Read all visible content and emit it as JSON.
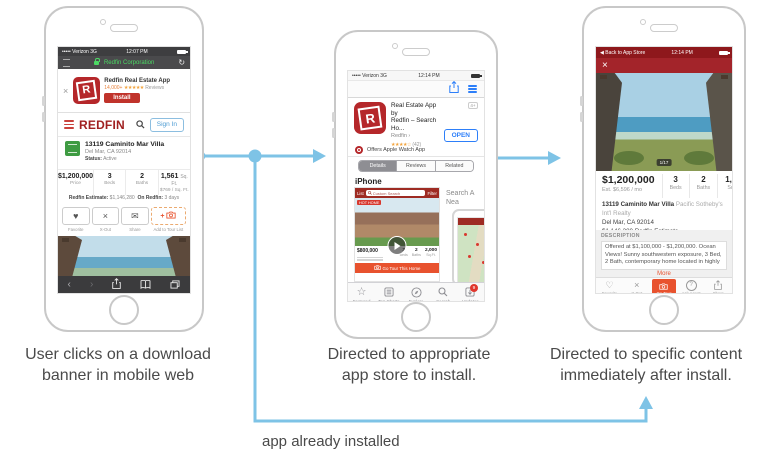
{
  "colors": {
    "arrow": "#7EC3E6",
    "redfin-red": "#A02021",
    "install-red": "#C0332B",
    "accent-orange": "#E8522E",
    "ios-blue": "#2D7FF9",
    "star-orange": "#F2A33C",
    "status-green": "#4CD964"
  },
  "captions": {
    "step1": "User clicks on a download\nbanner in mobile web",
    "step2": "Directed to appropriate\napp store to install.",
    "step3": "Directed to specific content\nimmediately after install.",
    "loop": "app already installed"
  },
  "phone1": {
    "status": {
      "carrier": "••••• Verizon 3G",
      "time": "12:07 PM"
    },
    "addressbar": {
      "title": "Redfin Corporation",
      "refresh": "↻"
    },
    "banner": {
      "close": "×",
      "logo_letter": "R",
      "app_name": "Redfin Real Estate App",
      "rating_count": "14,000+",
      "stars": "★★★★★",
      "reviews_label": "Reviews",
      "install_label": "Install"
    },
    "header": {
      "logo": "REDFIN",
      "sign_in": "Sign In"
    },
    "listing": {
      "address": "13119 Caminito Mar Villa",
      "city": "Del Mar, CA 92014",
      "status_label": "Status:",
      "status_value": "Active"
    },
    "stats": [
      {
        "value": "$1,200,000",
        "label": "Price"
      },
      {
        "value": "3",
        "label": "Beds"
      },
      {
        "value": "2",
        "label": "Baths"
      },
      {
        "value": "1,561",
        "unit": "Sq. Ft.",
        "label": "$769 / Sq. Ft."
      }
    ],
    "estimate": {
      "label": "Redfin Estimate:",
      "value": "$1,146,280",
      "on_label": "On Redfin:",
      "on_value": "3 days"
    },
    "actions": {
      "heart": "♥",
      "x": "×",
      "envelope": "✉",
      "plus": "+",
      "favorite": "Favorite",
      "xout": "X-Out",
      "share": "Share",
      "tour": "Add to Tour List"
    },
    "nav": {
      "back": "‹",
      "forward": "›"
    }
  },
  "phone2": {
    "status": {
      "carrier": "••••• Verizon 3G",
      "time": "12:14 PM"
    },
    "app": {
      "logo_letter": "R",
      "title": "Real Estate App by\nRedfin – Search Ho...",
      "developer": "Redfin ›",
      "age": "4+",
      "stars": "★★★★☆",
      "ratings": "(42)",
      "open_label": "OPEN",
      "watch": "Offers Apple Watch App"
    },
    "tabs": [
      {
        "label": "Details"
      },
      {
        "label": "Reviews"
      },
      {
        "label": "Related"
      }
    ],
    "section_heading": "iPhone",
    "shot1": {
      "list": "List",
      "search": "Custom Search",
      "filter": "Filter",
      "hot": "HOT HOME",
      "price": "$800,000",
      "beds": "3",
      "baths": "2",
      "sqft": "2,000",
      "beds_label": "Beds",
      "baths_label": "Baths",
      "sqft_label": "Sq.Ft.",
      "cta": "Go Tour This Home"
    },
    "shot2": {
      "line1": "Search A",
      "line2": "Nea"
    },
    "tabbar": [
      {
        "label": "Featured"
      },
      {
        "label": "Top Charts"
      },
      {
        "label": "Explore"
      },
      {
        "label": "Search"
      },
      {
        "label": "Updates"
      }
    ],
    "updates_badge": "9",
    "featured_star": "☆"
  },
  "phone3": {
    "status": {
      "back": "◀ Back to App Store",
      "time": "12:14 PM"
    },
    "close": "×",
    "photo_badge": "1/17",
    "price": {
      "value": "$1,200,000",
      "est": "Est. $6,596 / mo"
    },
    "stats": [
      {
        "value": "3",
        "label": "Beds"
      },
      {
        "value": "2",
        "label": "Baths"
      },
      {
        "value": "1,561",
        "label": "Sq. Ft."
      }
    ],
    "address": {
      "street": "13119 Caminito Mar Villa",
      "agency": "Pacific Sotheby's Int'l Realty",
      "city": "Del Mar, CA 92014",
      "estimate_value": "$1,146,280",
      "estimate_link": "Redfin Estimate"
    },
    "description": {
      "heading": "DESCRIPTION",
      "text": "Offered at $1,100,000 - $1,200,000. Ocean Views! Sunny southwestern exposure, 3 Bed, 2 Bath, contemporary home located in highly",
      "more": "More"
    },
    "toolbar": {
      "heart": "♡",
      "x": "×",
      "question": "?",
      "favorite": "Favorite",
      "xout": "X-Out",
      "tour": "Go Tour",
      "ask": "Ask Agent",
      "share": "Share"
    }
  }
}
